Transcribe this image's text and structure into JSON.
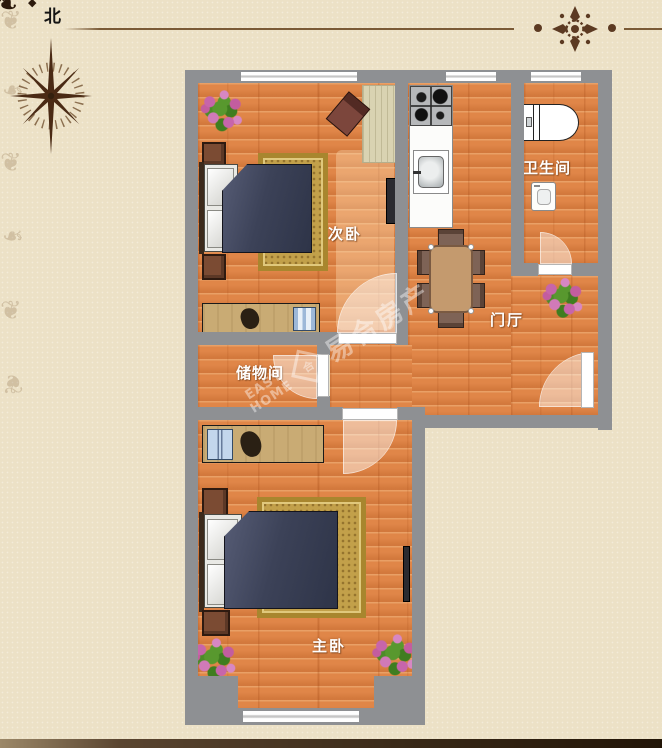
{
  "compass": {
    "north_label": "北"
  },
  "rooms": {
    "secondary_bedroom": {
      "label": "次卧"
    },
    "bathroom": {
      "label": "卫生间"
    },
    "entrance_hall": {
      "label": "门厅"
    },
    "storage_room": {
      "label": "储物间"
    },
    "master_bedroom": {
      "label": "主卧"
    }
  },
  "watermark": {
    "latin_top": "EASY",
    "latin_bottom": "HOME",
    "logo_glyph": "合",
    "brand": "易合房产"
  },
  "icons": {
    "compass_rose": "8-point-star",
    "top_divider": "rosette-with-dots-and-rules"
  },
  "colors": {
    "background": "#ece1c6",
    "wall": "#8e9093",
    "floor": "#e08648",
    "rug": "#c2a04a",
    "bed": "#3c4258",
    "ornament": "#5c3a22",
    "label": "#ffffff"
  }
}
